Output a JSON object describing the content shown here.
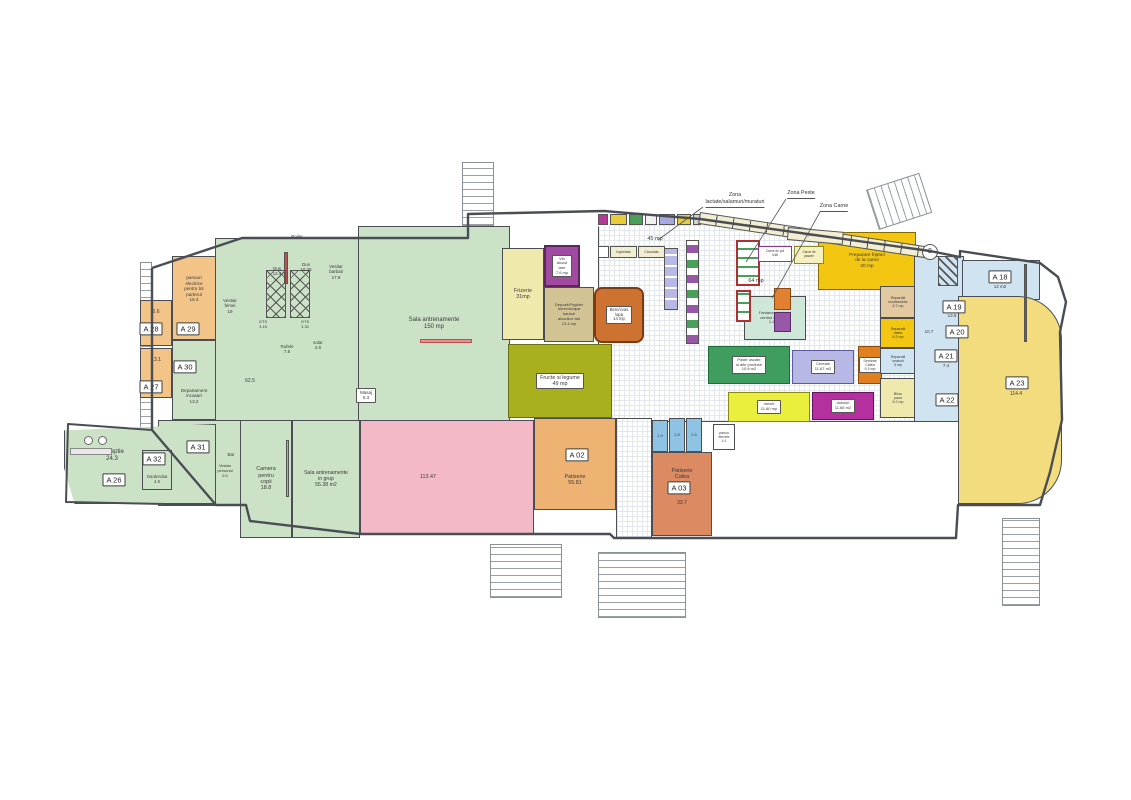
{
  "plan": {
    "wall_color": "#4a4e54",
    "palette": {
      "green": "#cbe2c6",
      "orange": "#f2c488",
      "pink": "#f4b9c6",
      "pale_yellow": "#efe9ad",
      "olive": "#a9b01d",
      "purple": "#a04ba0",
      "tan": "#d2c394",
      "burnt_orange": "#cd7230",
      "salmon": "#dc8a62",
      "bright_yellow": "#f3c711",
      "soft_yellow": "#f2dc7e",
      "magenta": "#b5309f",
      "light_blue": "#cfe3f0",
      "wc_blue": "#8fc3e4",
      "mint": "#cfe7d9",
      "shelf_green": "#3f9e5f",
      "lavender": "#b8b8e6"
    },
    "grids": [
      {
        "id": "market-floor",
        "x": 598,
        "y": 214,
        "w": 318,
        "h": 208,
        "clip": "polygon(0% 6%,32% 3%,100% 19%,100% 100%,0% 100%)"
      },
      {
        "id": "corridor-patiserie",
        "x": 616,
        "y": 418,
        "w": 36,
        "h": 120,
        "clip": ""
      }
    ],
    "rooms": [
      {
        "id": "vestiare-block",
        "x": 215,
        "y": 238,
        "w": 146,
        "h": 184,
        "bg": "#cbe2c6"
      },
      {
        "id": "sala-antrenamente",
        "x": 358,
        "y": 226,
        "w": 152,
        "h": 196,
        "bg": "#cbe2c6",
        "label": "Sala antrenamente\n150 mp",
        "fs": 6
      },
      {
        "id": "a31-zone",
        "x": 158,
        "y": 420,
        "w": 84,
        "h": 86,
        "bg": "#cbe2c6"
      },
      {
        "id": "receptie",
        "x": 64,
        "y": 424,
        "w": 152,
        "h": 80,
        "bg": "#cbe2c6",
        "clip": "polygon(0% 8%,100% 0%,100% 100%,7% 100%,0% 55%)",
        "label": "Receptie\n24.3",
        "fs": 6,
        "dx": -28,
        "dy": -8
      },
      {
        "id": "camera-copii",
        "x": 240,
        "y": 420,
        "w": 52,
        "h": 118,
        "bg": "#cbe2c6",
        "label": "Camera\npentru\ncopii\n18.8",
        "fs": 5.5
      },
      {
        "id": "sala-grup",
        "x": 292,
        "y": 420,
        "w": 68,
        "h": 118,
        "bg": "#cbe2c6",
        "label": "Sala antrenamente\nin grup\n55.38 m2",
        "fs": 5.2
      },
      {
        "id": "garderoba",
        "x": 142,
        "y": 450,
        "w": 30,
        "h": 40,
        "bg": "#cbe2c6",
        "label": "Garderoba\n4.5",
        "fs": 4.3,
        "dy": 9
      },
      {
        "id": "a29-panouri",
        "x": 172,
        "y": 256,
        "w": 44,
        "h": 84,
        "bg": "#f2c488",
        "label": "panouri\nelectrice\npentru tot\nparterul\n16.4",
        "fs": 4.6,
        "dy": -9
      },
      {
        "id": "a28",
        "x": 140,
        "y": 300,
        "w": 32,
        "h": 46,
        "bg": "#f2c488",
        "label": "6.6",
        "fs": 5.2,
        "dy": -11
      },
      {
        "id": "a27",
        "x": 140,
        "y": 348,
        "w": 32,
        "h": 50,
        "bg": "#f2c488",
        "label": "13.1",
        "fs": 5.2,
        "dy": -13
      },
      {
        "id": "a30-departament",
        "x": 172,
        "y": 340,
        "w": 44,
        "h": 80,
        "bg": "#cbe2c6",
        "label": "Departament\nincasari\n13.2",
        "fs": 4.6,
        "dy": 16
      },
      {
        "id": "sala-pink",
        "x": 360,
        "y": 420,
        "w": 174,
        "h": 115,
        "bg": "#f4b9c6",
        "label": "113.47",
        "fs": 5.4,
        "dx": -19
      },
      {
        "id": "frizerie",
        "x": 502,
        "y": 248,
        "w": 42,
        "h": 92,
        "bg": "#efe9ad",
        "label": "Frizerie\n31mp",
        "fs": 5.4
      },
      {
        "id": "vin-alcool",
        "x": 544,
        "y": 245,
        "w": 36,
        "h": 42,
        "bg": "#a04ba0",
        "br": "#5c2660",
        "bw": 2.5,
        "label": "Vin\nalcool\ntare\n7.6 mp",
        "fs": 4,
        "box": true
      },
      {
        "id": "depozit-frigider",
        "x": 544,
        "y": 287,
        "w": 50,
        "h": 55,
        "bg": "#d2c394",
        "label": "Depozit/Frigider\nbere/vin/apa\nbauturi\nalcoolice tari\n13.4 mp",
        "fs": 4
      },
      {
        "id": "bere-cvas",
        "x": 594,
        "y": 287,
        "w": 50,
        "h": 56,
        "bg": "#cd7230",
        "br": "#7a3a12",
        "bw": 2.5,
        "rad": "8px",
        "label": "Bere/cvas\n/apa\n14 mp",
        "fs": 4.2,
        "box": true
      },
      {
        "id": "fructe-legume",
        "x": 508,
        "y": 344,
        "w": 104,
        "h": 74,
        "bg": "#a9b01d",
        "br": "#6a7010",
        "label": "Fructe si legume\n49 mp",
        "fs": 5.4,
        "box": true
      },
      {
        "id": "a02-patiserie",
        "x": 534,
        "y": 418,
        "w": 82,
        "h": 92,
        "bg": "#eeb273",
        "label": "Patiserie\n55.81",
        "fs": 5.4,
        "dy": 16
      },
      {
        "id": "wc-1",
        "x": 652,
        "y": 420,
        "w": 16,
        "h": 32,
        "bg": "#8fc3e4",
        "label": "1.9",
        "fs": 4
      },
      {
        "id": "wc-2",
        "x": 669,
        "y": 418,
        "w": 16,
        "h": 34,
        "bg": "#8fc3e4",
        "label": "2.8",
        "fs": 4
      },
      {
        "id": "wc-3",
        "x": 686,
        "y": 418,
        "w": 16,
        "h": 34,
        "bg": "#8fc3e4",
        "label": "2.5",
        "fs": 4
      },
      {
        "id": "a03-patiserie-cafea",
        "x": 652,
        "y": 452,
        "w": 60,
        "h": 84,
        "bg": "#dc8a62",
        "label": "Patiserie\nCafea",
        "fs": 5.4,
        "dy": -20
      },
      {
        "id": "panou-electric",
        "x": 713,
        "y": 424,
        "w": 22,
        "h": 26,
        "bg": "#ffffff",
        "label": "panou\nelectric\n4.1",
        "fs": 3.5
      },
      {
        "id": "preparare-carne",
        "x": 818,
        "y": 232,
        "w": 98,
        "h": 58,
        "bg": "#f3c711",
        "br": "#8a6a00",
        "label": "Preparare fripturi\nde la carne\n20 mp",
        "fs": 4.8
      },
      {
        "id": "fantana-plante",
        "x": 744,
        "y": 296,
        "w": 62,
        "h": 44,
        "bg": "#cfe7d9",
        "label": "Fantana arteziana\ncentrul de plante\n1.2 m2",
        "fs": 4
      },
      {
        "id": "paste-uscate",
        "x": 708,
        "y": 346,
        "w": 82,
        "h": 38,
        "bg": "#3f9e5f",
        "br": "#1e6e3a",
        "label": "Paste uscate\nsi alte produse\n10.8 m2",
        "fs": 4,
        "box": true
      },
      {
        "id": "cereale",
        "x": 792,
        "y": 350,
        "w": 62,
        "h": 34,
        "bg": "#b8b8e6",
        "br": "#5a5aa0",
        "label": "Cereale\n11.67 m2",
        "fs": 4,
        "box": true
      },
      {
        "id": "seminte-cafea",
        "x": 858,
        "y": 346,
        "w": 24,
        "h": 38,
        "bg": "#e0801e",
        "br": "#8a4a10",
        "label": "Seminte\nCafea\n9.3 mp",
        "fs": 3.6,
        "box": true
      },
      {
        "id": "mezel",
        "x": 728,
        "y": 392,
        "w": 82,
        "h": 30,
        "bg": "#eaef3e",
        "br": "#8a8a10",
        "label": "mezel\n11.60 mp",
        "fs": 4,
        "box": true
      },
      {
        "id": "dulciuri",
        "x": 812,
        "y": 392,
        "w": 62,
        "h": 28,
        "bg": "#b5309f",
        "br": "#6a1060",
        "label": "dulciuri\n11.66 m2",
        "fs": 4,
        "box": true
      },
      {
        "id": "reparatii-incaltaminte",
        "x": 880,
        "y": 286,
        "w": 36,
        "h": 32,
        "bg": "#e2c9a0",
        "label": "Reparatii\nincaltaminte\n6.7 mp",
        "fs": 3.6
      },
      {
        "id": "reparatii-haine",
        "x": 880,
        "y": 318,
        "w": 36,
        "h": 30,
        "bg": "#f3c711",
        "label": "Reparatii\nhaine\n6.3 mp",
        "fs": 3.6
      },
      {
        "id": "reparatii-ceasuri",
        "x": 880,
        "y": 348,
        "w": 36,
        "h": 26,
        "bg": "#cfe3f0",
        "label": "Reparatii\nceasuri\n5 mp",
        "fs": 3.6
      },
      {
        "id": "birou-paza",
        "x": 880,
        "y": 378,
        "w": 36,
        "h": 40,
        "bg": "#efe9ad",
        "label": "Birou\npaza\n8.2 mp",
        "fs": 3.6
      },
      {
        "id": "blue-wing",
        "x": 914,
        "y": 256,
        "w": 50,
        "h": 166,
        "bg": "#cfe3f0"
      },
      {
        "id": "a18",
        "x": 962,
        "y": 260,
        "w": 78,
        "h": 40,
        "bg": "#cfe3f0"
      },
      {
        "id": "a23",
        "x": 958,
        "y": 296,
        "w": 104,
        "h": 208,
        "bg": "#f2dc7e",
        "rad": "0 44px 44px 0"
      }
    ],
    "fixtures": [
      {
        "id": "shelf-a",
        "x": 598,
        "y": 214,
        "w": 10,
        "h": 11,
        "bg": "#b83898"
      },
      {
        "id": "shelf-b",
        "x": 610,
        "y": 214,
        "w": 17,
        "h": 11,
        "bg": "#e8cc38"
      },
      {
        "id": "shelf-c",
        "x": 629,
        "y": 214,
        "w": 14,
        "h": 11,
        "bg": "#48a058"
      },
      {
        "id": "shelf-d",
        "x": 645,
        "y": 214,
        "w": 12,
        "h": 11,
        "bg": "#f0f0f0"
      },
      {
        "id": "shelf-e",
        "x": 659,
        "y": 214,
        "w": 16,
        "h": 11,
        "bg": "#a8a8e0"
      },
      {
        "id": "shelf-f",
        "x": 677,
        "y": 214,
        "w": 14,
        "h": 11,
        "bg": "#e8cc38"
      },
      {
        "id": "shelf-g",
        "x": 693,
        "y": 214,
        "w": 8,
        "h": 11,
        "bg": "#d0d0d0"
      },
      {
        "id": "shelf-strip",
        "x": 700,
        "y": 212,
        "w": 234,
        "h": 12,
        "rot": 8.6,
        "css": "background:repeating-linear-gradient(90deg,#f2eed2 0 16px,#4a4e54 16px 17px);"
      },
      {
        "id": "vitrina-inghetata",
        "x": 610,
        "y": 246,
        "w": 27,
        "h": 12,
        "bg": "#f2eed2",
        "label": "Inghetata",
        "fs": 3.4
      },
      {
        "id": "vitrina-ciocolata",
        "x": 638,
        "y": 246,
        "w": 27,
        "h": 12,
        "bg": "#f2eed2",
        "label": "Ciocolata",
        "fs": 3.4
      },
      {
        "id": "vitrina-capat",
        "x": 598,
        "y": 246,
        "w": 11,
        "h": 12,
        "bg": "#ffffff"
      },
      {
        "id": "raft-vertical",
        "x": 664,
        "y": 248,
        "w": 14,
        "h": 62,
        "css": "background:repeating-linear-gradient(0deg,#b8b8e6 0 9px,#fff 9px 11px);"
      },
      {
        "id": "raft-stanga",
        "x": 686,
        "y": 240,
        "w": 13,
        "h": 104,
        "css": "background:repeating-linear-gradient(0deg,#9858a8 0 8px,#fff 8px 15px,#48a058 15px 23px,#fff 23px 30px);"
      },
      {
        "id": "vitrina-peste",
        "x": 736,
        "y": 240,
        "w": 24,
        "h": 46,
        "br": "#b03030",
        "bw": 2,
        "css": "background:repeating-linear-gradient(0deg,#fff 0 7px,#48a058 7px 9px);"
      },
      {
        "id": "vitrina-peste-2",
        "x": 736,
        "y": 290,
        "w": 15,
        "h": 32,
        "br": "#b03030",
        "bw": 2,
        "css": "background:repeating-linear-gradient(0deg,#fff 0 7px,#48a058 7px 9px);"
      },
      {
        "id": "carne-de-pui",
        "x": 758,
        "y": 246,
        "w": 34,
        "h": 16,
        "bg": "#ffffff",
        "br": "#8a3a8a",
        "label": "Carne de pui\n4.68",
        "fs": 3.2
      },
      {
        "id": "carne-de-pasare",
        "x": 794,
        "y": 246,
        "w": 30,
        "h": 18,
        "bg": "#f5f0c0",
        "br": "#8a8a30",
        "label": "Carne de\npasare",
        "fs": 3.2
      },
      {
        "id": "frigidere-sertare",
        "x": 788,
        "y": 227,
        "w": 56,
        "h": 13,
        "rot": 5,
        "bg": "#f2eed2",
        "label": "Frigidere sertare",
        "fs": 3.2
      },
      {
        "id": "insula-1",
        "x": 774,
        "y": 288,
        "w": 17,
        "h": 22,
        "bg": "#e08030",
        "br": "#8a4a10"
      },
      {
        "id": "insula-2",
        "x": 774,
        "y": 312,
        "w": 17,
        "h": 20,
        "bg": "#9858a8",
        "br": "#5a2a6a"
      },
      {
        "id": "hasura-a18",
        "x": 938,
        "y": 256,
        "w": 20,
        "h": 30,
        "css": "background:repeating-linear-gradient(45deg,#555 0 1.5px,transparent 1.5px 6px);"
      },
      {
        "id": "marcaj-2",
        "x": 922,
        "y": 244,
        "w": 16,
        "h": 16,
        "bg": "#ffffff",
        "br": "#555555",
        "rad": "50%",
        "label": "2",
        "fs": 7
      },
      {
        "id": "lift-bar",
        "x": 284,
        "y": 252,
        "w": 4,
        "h": 32,
        "bg": "#c05050"
      },
      {
        "id": "banda-sala",
        "x": 420,
        "y": 339,
        "w": 52,
        "h": 4,
        "bg": "#e89090",
        "br": "#c05050"
      },
      {
        "id": "banda-grup",
        "x": 286,
        "y": 440,
        "w": 3,
        "h": 57,
        "bg": "#e89090"
      },
      {
        "id": "banda-a23",
        "x": 1024,
        "y": 264,
        "w": 3,
        "h": 78,
        "bg": "#b04040"
      },
      {
        "id": "birou-receptie",
        "x": 70,
        "y": 448,
        "w": 42,
        "h": 7,
        "bg": "#e8e8e8",
        "br": "#888888"
      },
      {
        "id": "taburet-1",
        "x": 84,
        "y": 436,
        "w": 9,
        "h": 9,
        "bg": "#ffffff",
        "br": "#666666",
        "rad": "50%"
      },
      {
        "id": "taburet-2",
        "x": 98,
        "y": 436,
        "w": 9,
        "h": 9,
        "bg": "#ffffff",
        "br": "#666666",
        "rad": "50%"
      },
      {
        "id": "lift-1",
        "x": 266,
        "y": 270,
        "w": 20,
        "h": 48,
        "br": "#555555",
        "css": "background-image:repeating-linear-gradient(45deg,#555 0 1px,transparent 1px 8px),repeating-linear-gradient(-45deg,#555 0 1px,transparent 1px 8px);"
      },
      {
        "id": "lift-2",
        "x": 290,
        "y": 270,
        "w": 20,
        "h": 48,
        "br": "#555555",
        "css": "background-image:repeating-linear-gradient(45deg,#555 0 1px,transparent 1px 8px),repeating-linear-gradient(-45deg,#555 0 1px,transparent 1px 8px);"
      }
    ],
    "stairs": [
      {
        "id": "scara-sus-centru",
        "x": 462,
        "y": 162,
        "w": 32,
        "h": 64,
        "rot": 0,
        "dir": 0
      },
      {
        "id": "scara-sus-dreapta",
        "x": 866,
        "y": 190,
        "w": 56,
        "h": 42,
        "rot": -18,
        "dir": 90
      },
      {
        "id": "scara-dreapta",
        "x": 1002,
        "y": 518,
        "w": 38,
        "h": 88,
        "rot": 0,
        "dir": 0
      },
      {
        "id": "scara-jos-1",
        "x": 490,
        "y": 544,
        "w": 72,
        "h": 54,
        "rot": 0,
        "dir": 0
      },
      {
        "id": "scara-jos-2",
        "x": 598,
        "y": 552,
        "w": 88,
        "h": 66,
        "rot": 0,
        "dir": 0
      },
      {
        "id": "balcon-stanga",
        "x": 140,
        "y": 262,
        "w": 12,
        "h": 170,
        "rot": 0,
        "dir": 0
      }
    ],
    "labels": [
      {
        "t": "Boiler",
        "x": 297,
        "y": 234,
        "fs": 4.5
      },
      {
        "t": "Dus\n12.4",
        "x": 277,
        "y": 266,
        "fs": 4.5
      },
      {
        "t": "Dus\n10.25",
        "x": 306,
        "y": 262,
        "fs": 4.5
      },
      {
        "t": "Vestiar\nbarbati\n17.8",
        "x": 336,
        "y": 264,
        "fs": 4.5
      },
      {
        "t": "Vestiar\nfemei\n19",
        "x": 230,
        "y": 298,
        "fs": 4.5
      },
      {
        "t": "GTS\n3.15",
        "x": 263,
        "y": 320,
        "fs": 4
      },
      {
        "t": "GTS\n3.32",
        "x": 305,
        "y": 320,
        "fs": 4
      },
      {
        "t": "Rufele\n7.8",
        "x": 287,
        "y": 344,
        "fs": 4.5
      },
      {
        "t": "solar\n2.6",
        "x": 318,
        "y": 340,
        "fs": 4.5
      },
      {
        "t": "62.5",
        "x": 250,
        "y": 378,
        "fs": 5
      },
      {
        "t": "Masaj\n5.3",
        "x": 366,
        "y": 388,
        "fs": 4.5,
        "box": true
      },
      {
        "t": "Bar",
        "x": 231,
        "y": 452,
        "fs": 4.5
      },
      {
        "t": "Vestiar\npersonal\n5.5",
        "x": 225,
        "y": 464,
        "fs": 4
      },
      {
        "t": "45 mp",
        "x": 655,
        "y": 236,
        "fs": 5.5
      },
      {
        "t": "64 mp",
        "x": 756,
        "y": 278,
        "fs": 5.5
      },
      {
        "t": "12 m2",
        "x": 1000,
        "y": 284,
        "fs": 4.5
      },
      {
        "t": "13.5",
        "x": 952,
        "y": 313,
        "fs": 4.5
      },
      {
        "t": "10.7",
        "x": 929,
        "y": 329,
        "fs": 4.5
      },
      {
        "t": "7.4",
        "x": 946,
        "y": 363,
        "fs": 4.5
      },
      {
        "t": "114.4",
        "x": 1016,
        "y": 391,
        "fs": 5
      },
      {
        "t": "33.7",
        "x": 682,
        "y": 500,
        "fs": 5
      }
    ],
    "tags": [
      {
        "t": "A 26",
        "x": 114,
        "y": 480
      },
      {
        "t": "A 27",
        "x": 151,
        "y": 387
      },
      {
        "t": "A 28",
        "x": 151,
        "y": 329
      },
      {
        "t": "A 29",
        "x": 188,
        "y": 329
      },
      {
        "t": "A 30",
        "x": 185,
        "y": 367
      },
      {
        "t": "A 31",
        "x": 198,
        "y": 447
      },
      {
        "t": "A 32",
        "x": 154,
        "y": 459
      },
      {
        "t": "A 02",
        "x": 577,
        "y": 455
      },
      {
        "t": "A 03",
        "x": 679,
        "y": 488
      },
      {
        "t": "A 18",
        "x": 1000,
        "y": 277
      },
      {
        "t": "A 19",
        "x": 954,
        "y": 307
      },
      {
        "t": "A 20",
        "x": 957,
        "y": 332
      },
      {
        "t": "A 21",
        "x": 946,
        "y": 356
      },
      {
        "t": "A 22",
        "x": 947,
        "y": 400
      },
      {
        "t": "A 23",
        "x": 1017,
        "y": 383
      }
    ],
    "zones": [
      {
        "t": "Zona\nlactate/salamuri/muraturi",
        "x": 735,
        "y": 192
      },
      {
        "t": "Zona Peste",
        "x": 801,
        "y": 190
      },
      {
        "t": "Zona Carne",
        "x": 834,
        "y": 203
      }
    ],
    "leaders": [
      {
        "x1": 703,
        "y1": 207,
        "x2": 658,
        "y2": 240
      },
      {
        "x1": 786,
        "y1": 199,
        "x2": 746,
        "y2": 262
      },
      {
        "x1": 820,
        "y1": 212,
        "x2": 772,
        "y2": 298
      }
    ],
    "outline": "152,268 242,238 468,238 468,214 604,211 700,219 930,251 960,257 960,251 1040,263 1058,277 1066,302 1060,332 1062,420 1050,472 1040,505 958,505 956,538 720,538 614,538 610,534 360,534 250,521 246,505 216,505 152,430 152,268",
    "annex": "152,430 68,424 66,502 216,505"
  }
}
